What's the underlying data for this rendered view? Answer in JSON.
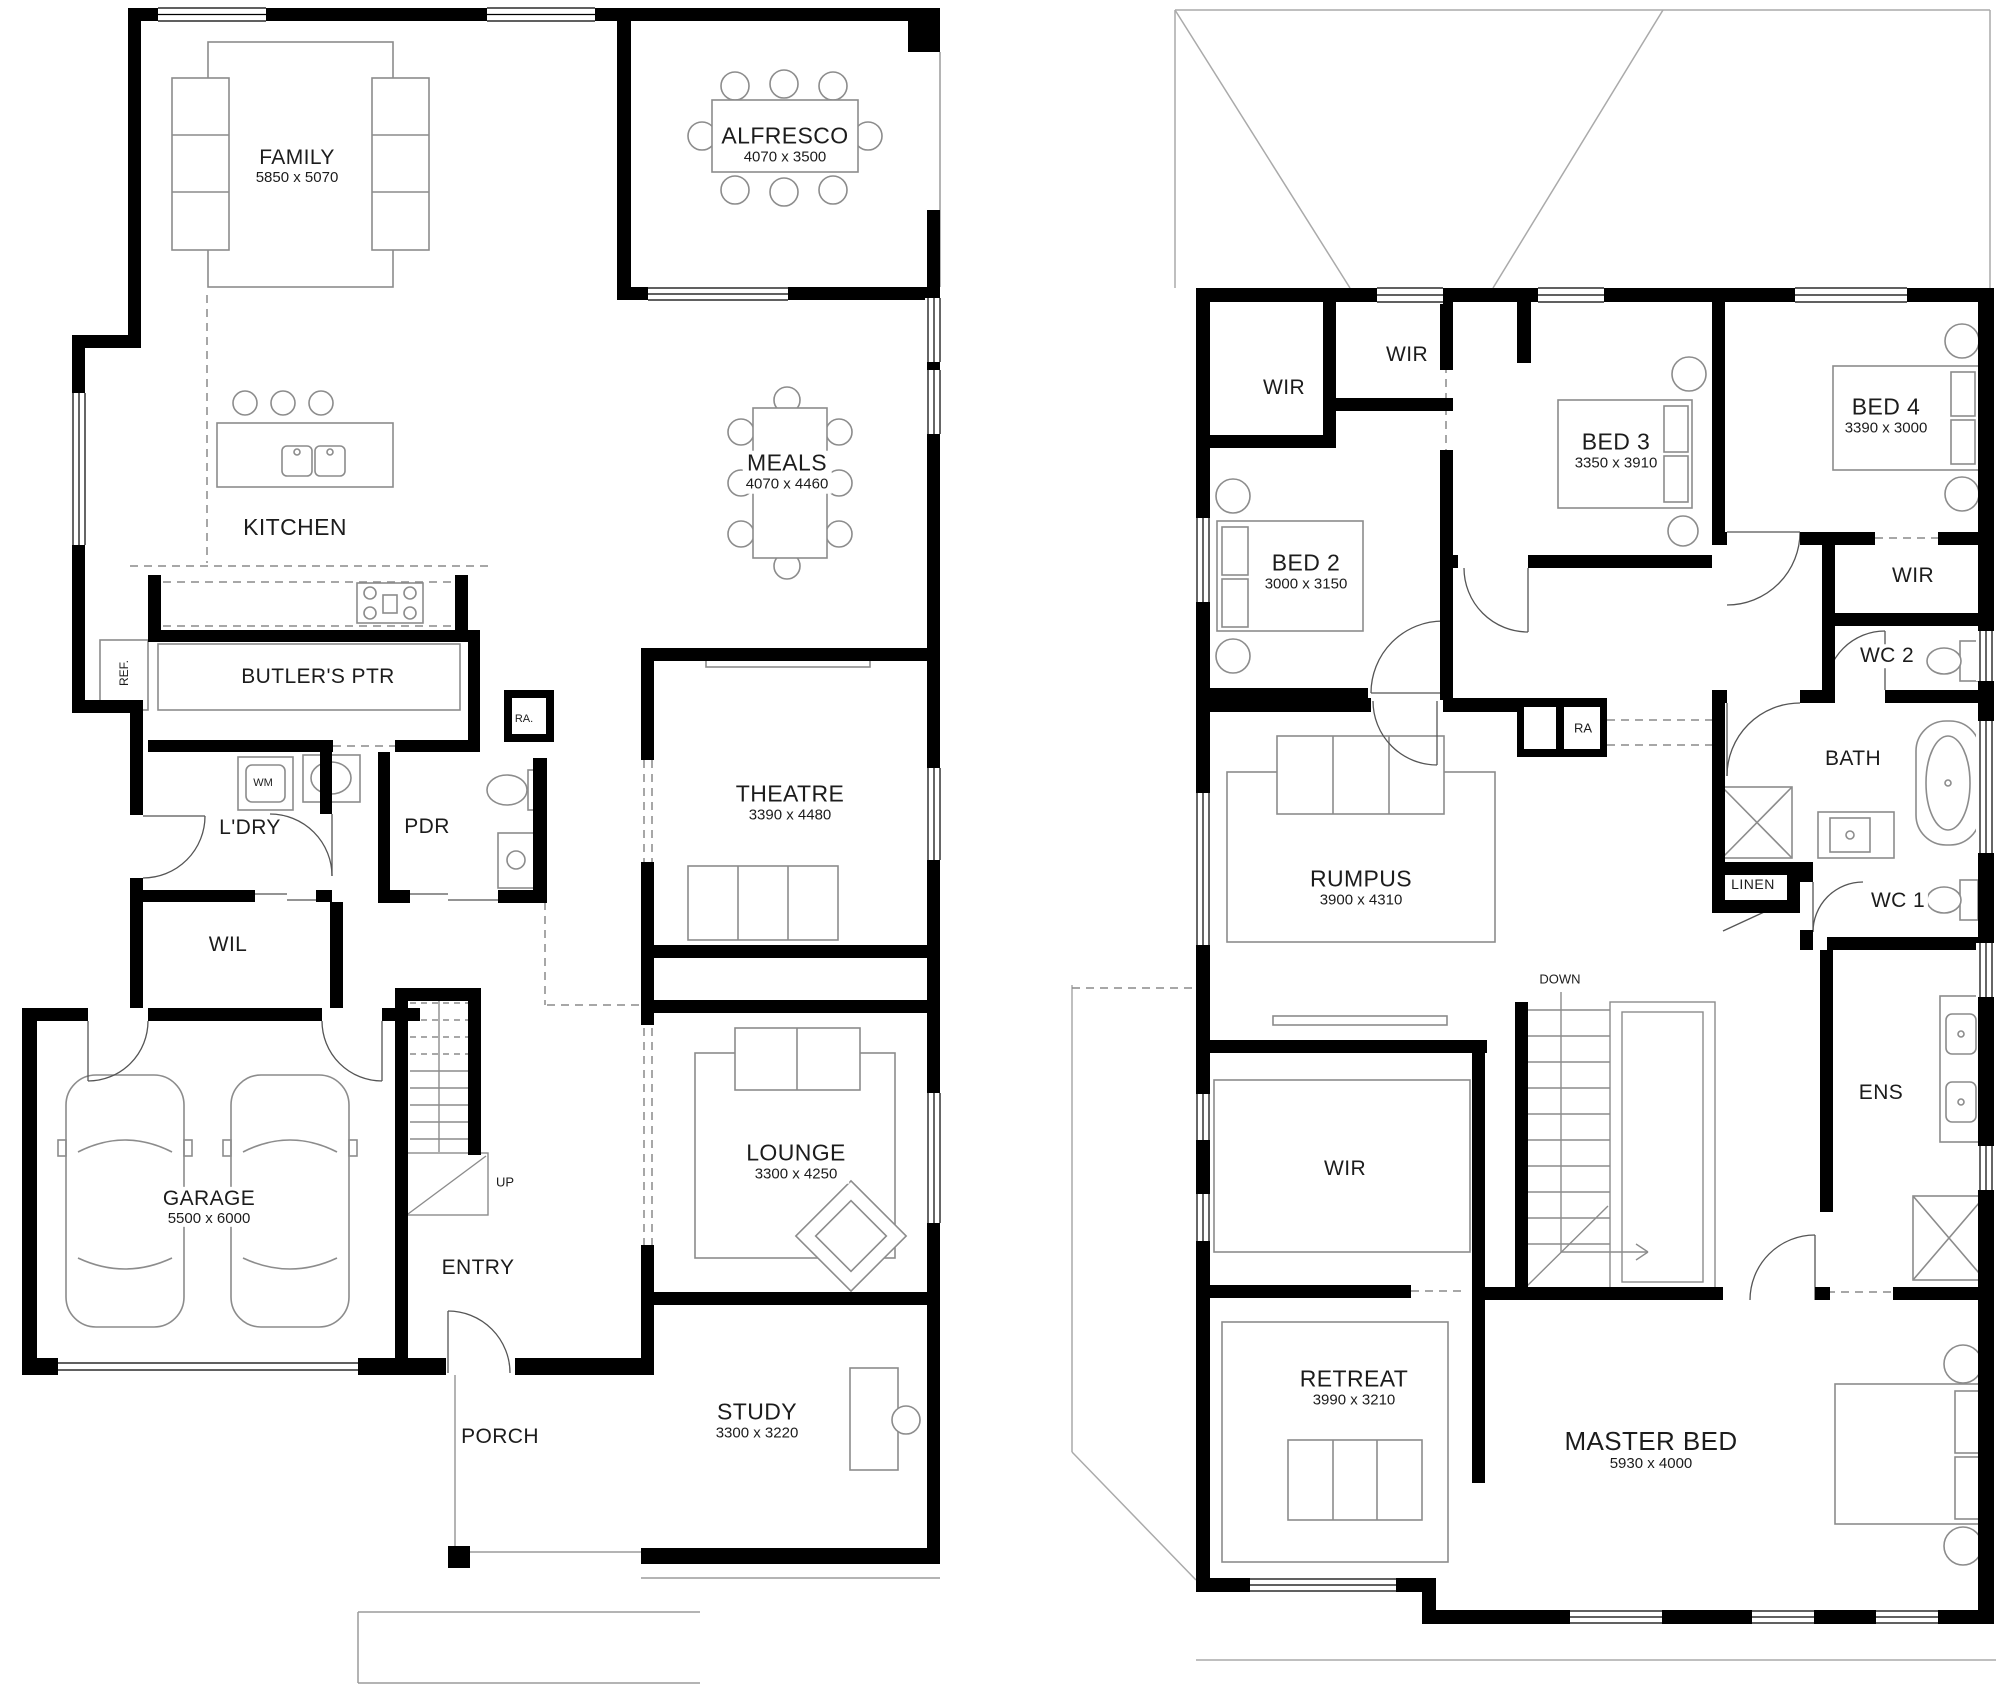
{
  "ground": {
    "rooms": {
      "family": {
        "name": "FAMILY",
        "dims": "5850 x 5070"
      },
      "alfresco": {
        "name": "ALFRESCO",
        "dims": "4070 x 3500"
      },
      "kitchen": {
        "name": "KITCHEN"
      },
      "meals": {
        "name": "MEALS",
        "dims": "4070 x 4460"
      },
      "butlers": {
        "name": "BUTLER'S PTR"
      },
      "ldry": {
        "name": "L'DRY"
      },
      "pdr": {
        "name": "PDR"
      },
      "wil": {
        "name": "WIL"
      },
      "theatre": {
        "name": "THEATRE",
        "dims": "3390 x 4480"
      },
      "garage": {
        "name": "GARAGE",
        "dims": "5500 x 6000"
      },
      "lounge": {
        "name": "LOUNGE",
        "dims": "3300 x 4250"
      },
      "study": {
        "name": "STUDY",
        "dims": "3300 x 3220"
      },
      "entry": {
        "name": "ENTRY"
      },
      "porch": {
        "name": "PORCH"
      }
    },
    "annotations": {
      "ref": "REF.",
      "ra": "RA.",
      "wm": "WM",
      "up": "UP"
    }
  },
  "first": {
    "rooms": {
      "wir_a": {
        "name": "WIR"
      },
      "wir_b": {
        "name": "WIR"
      },
      "bed2": {
        "name": "BED 2",
        "dims": "3000 x 3150"
      },
      "bed3": {
        "name": "BED 3",
        "dims": "3350 x 3910"
      },
      "bed4": {
        "name": "BED 4",
        "dims": "3390 x 3000"
      },
      "wir_c": {
        "name": "WIR"
      },
      "wc2": {
        "name": "WC 2"
      },
      "bath": {
        "name": "BATH"
      },
      "rumpus": {
        "name": "RUMPUS",
        "dims": "3900 x 4310"
      },
      "linen": {
        "name": "LINEN"
      },
      "wc1": {
        "name": "WC 1"
      },
      "ens": {
        "name": "ENS"
      },
      "wir_d": {
        "name": "WIR"
      },
      "retreat": {
        "name": "RETREAT",
        "dims": "3990 x 3210"
      },
      "master": {
        "name": "MASTER BED",
        "dims": "5930 x 4000"
      }
    },
    "annotations": {
      "ra": "RA",
      "down": "DOWN"
    }
  },
  "colors": {
    "wall": "#000000",
    "furniture_line": "#8c8c8c",
    "roof_line": "#aaaaaa",
    "door_line": "#555555"
  }
}
